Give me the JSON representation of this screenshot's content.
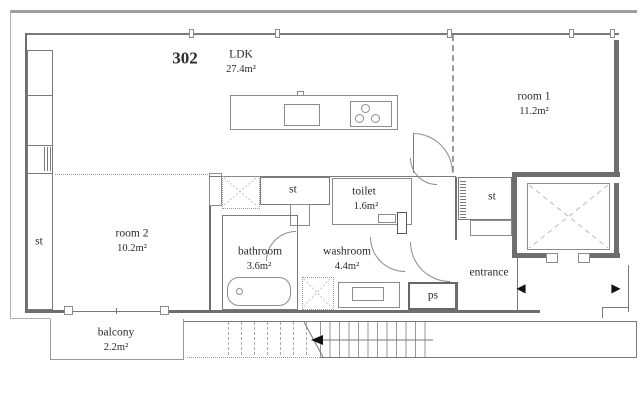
{
  "plan": {
    "unit_number": "302",
    "rooms": {
      "ldk": {
        "name": "LDK",
        "area": "27.4m²"
      },
      "room1": {
        "name": "room 1",
        "area": "11.2m²"
      },
      "room2": {
        "name": "room 2",
        "area": "10.2m²"
      },
      "bathroom": {
        "name": "bathroom",
        "area": "3.6m²"
      },
      "washroom": {
        "name": "washroom",
        "area": "4.4m²"
      },
      "toilet": {
        "name": "toilet",
        "area": "1.6m²"
      },
      "balcony": {
        "name": "balcony",
        "area": "2.2m²"
      },
      "entrance": {
        "name": "entrance"
      },
      "storage_left": {
        "name": "st"
      },
      "storage_hall": {
        "name": "st"
      },
      "storage_entrance": {
        "name": "st"
      },
      "pipe_space": {
        "name": "ps"
      }
    },
    "icons": {
      "left_arrow": "◀",
      "right_arrow": "▶"
    },
    "colors": {
      "wall": "#6e6e6e",
      "line": "#8c8c8c",
      "outer": "#9e9e9e",
      "text": "#2b2b2b"
    }
  }
}
